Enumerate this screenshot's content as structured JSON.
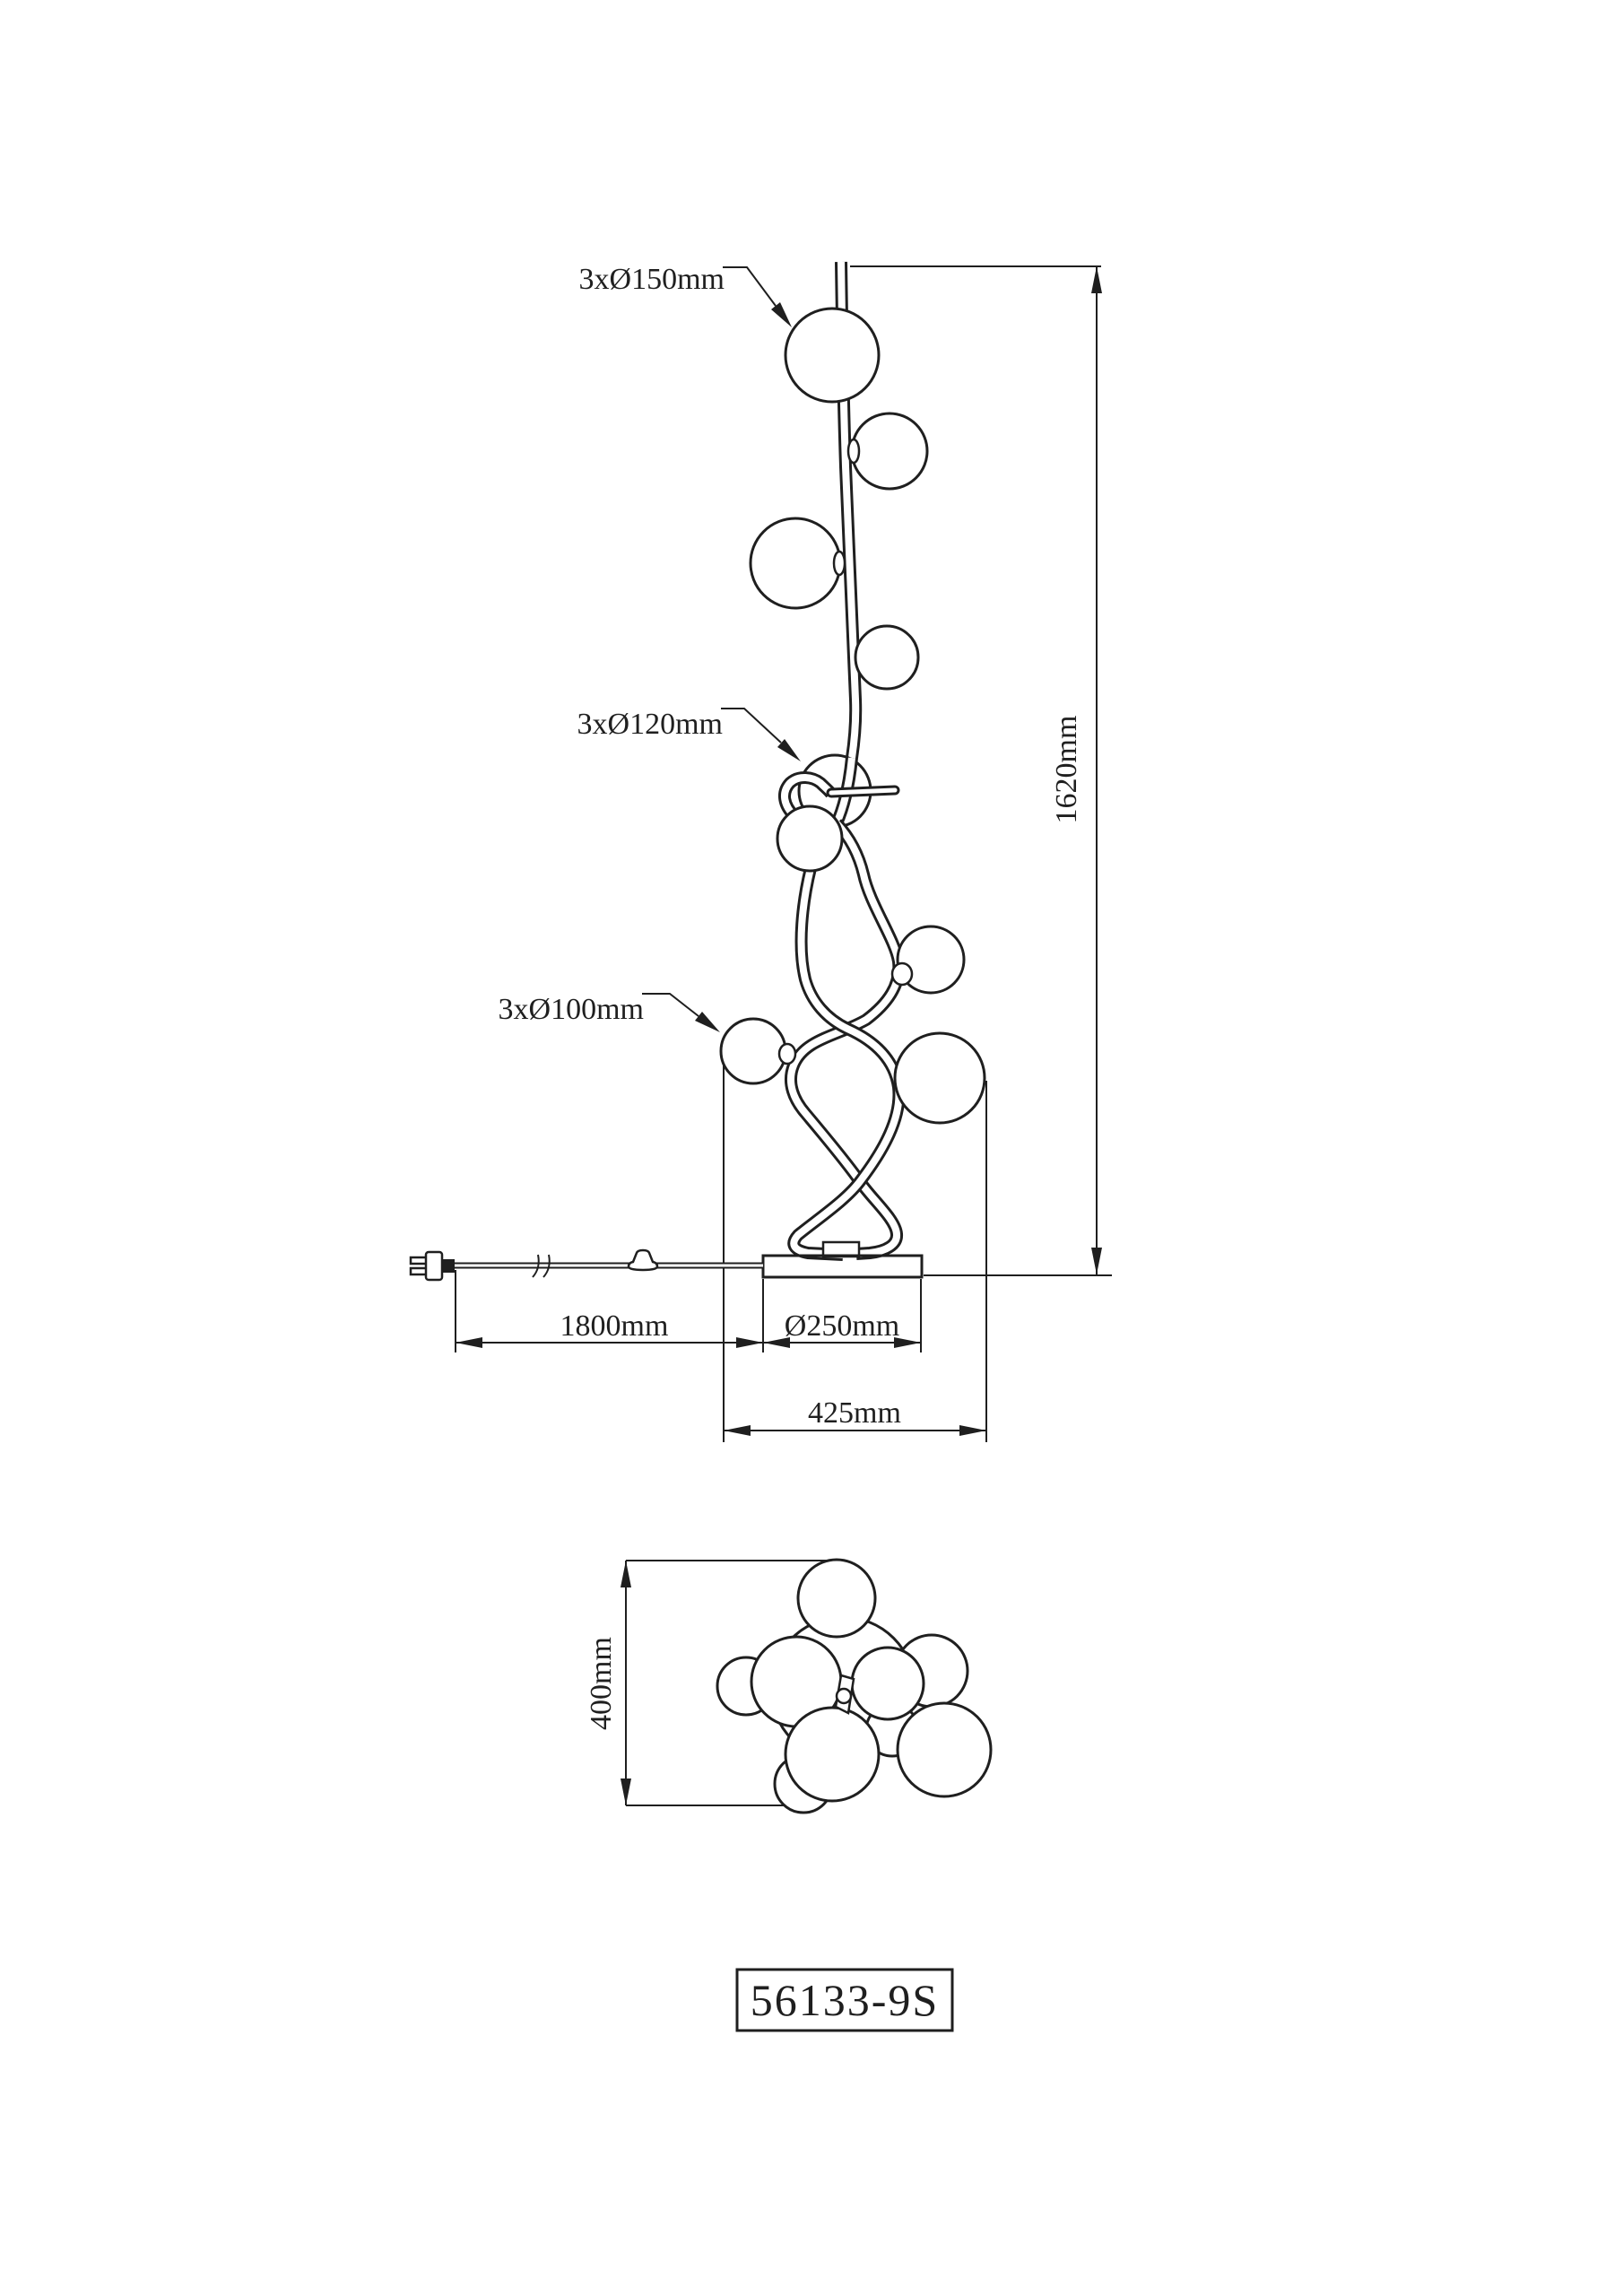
{
  "drawing": {
    "labels": {
      "spheres_150": {
        "label": "3xØ150mm",
        "count": 3,
        "diameter_mm": 150
      },
      "spheres_120": {
        "label": "3xØ120mm",
        "count": 3,
        "diameter_mm": 120
      },
      "spheres_100": {
        "label": "3xØ100mm",
        "count": 3,
        "diameter_mm": 100
      }
    },
    "dimensions": {
      "total_height": {
        "label": "1620mm",
        "value_mm": 1620
      },
      "cord_length": {
        "label": "1800mm",
        "value_mm": 1800
      },
      "base_diameter": {
        "label": "Ø250mm",
        "value_mm": 250
      },
      "overall_width": {
        "label": "425mm",
        "value_mm": 425
      },
      "top_view_depth": {
        "label": "400mm",
        "value_mm": 400
      }
    },
    "title_block": {
      "model_number": "56133-9S"
    },
    "icons": {
      "power_plug": "power-plug-icon",
      "power_switch": "inline-switch-icon",
      "cord_break": "cord-break-icon"
    },
    "colors": {
      "line": "#1f1f1f",
      "background": "#ffffff"
    }
  }
}
